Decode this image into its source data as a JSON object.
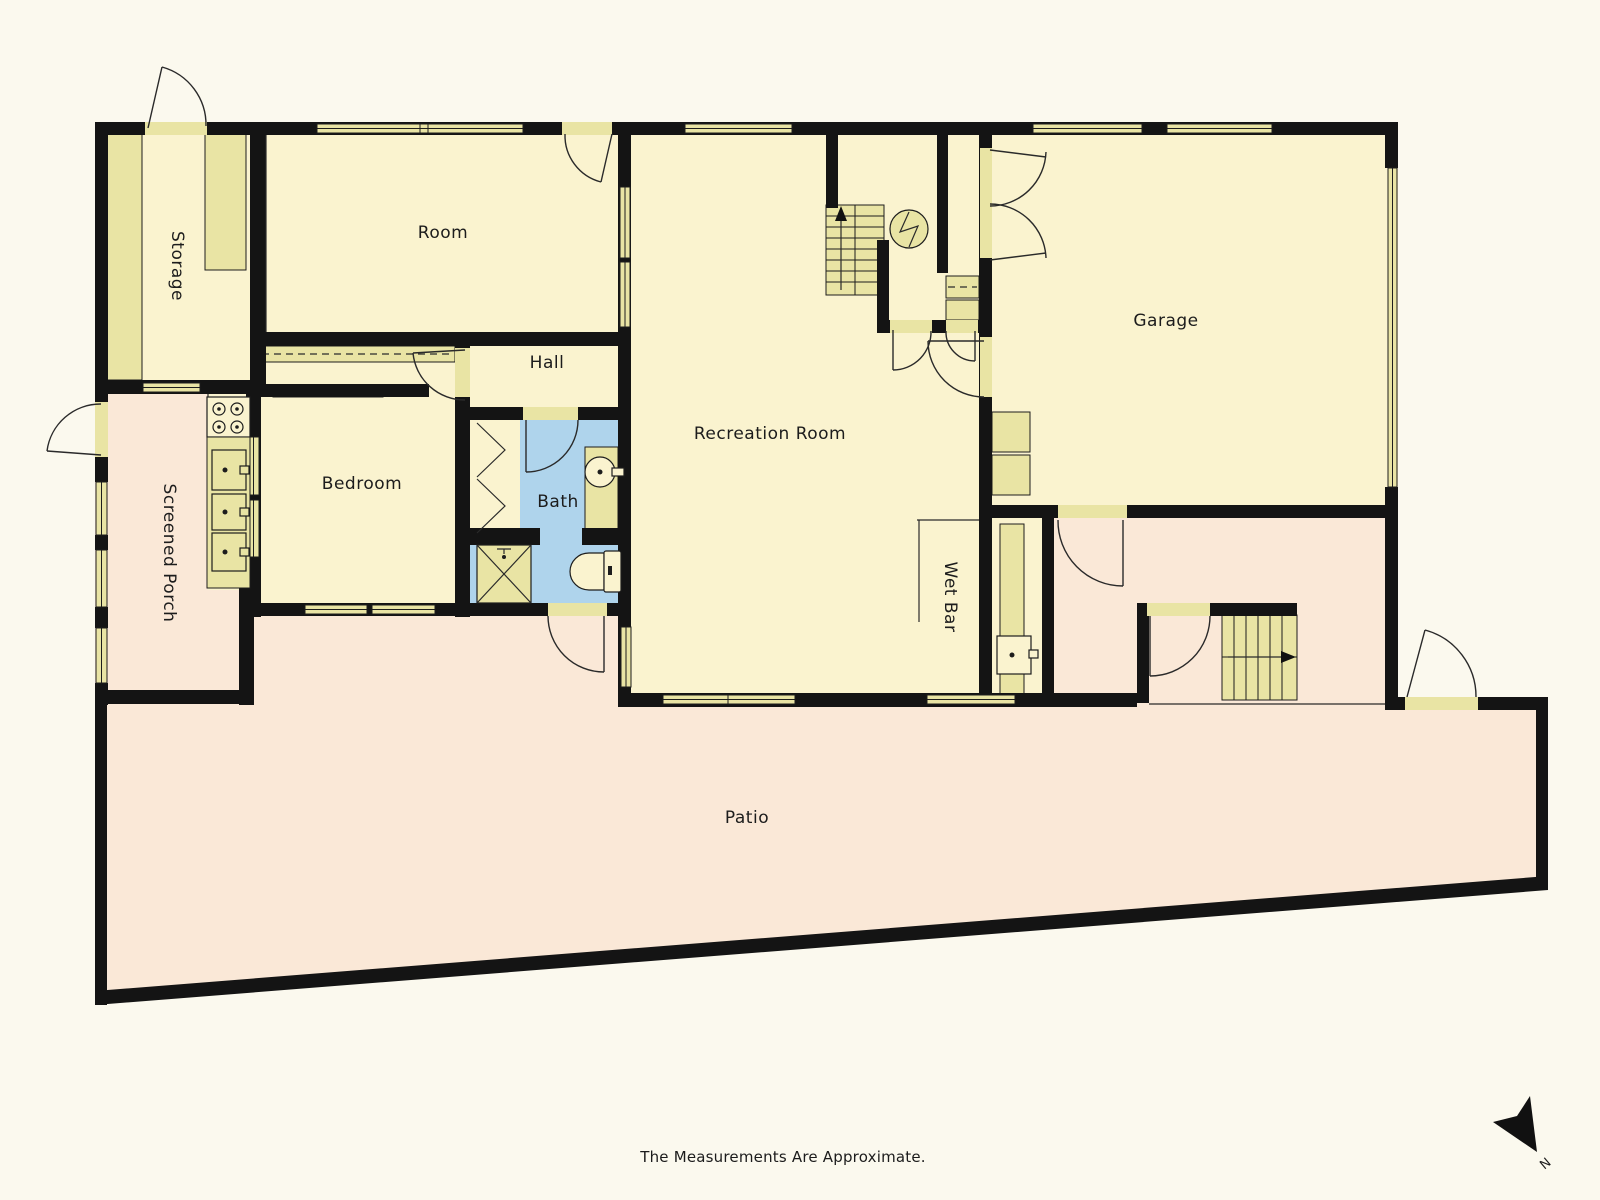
{
  "rooms": {
    "storage": "Storage",
    "room": "Room",
    "hall": "Hall",
    "bedroom": "Bedroom",
    "bath": "Bath",
    "recreation": "Recreation Room",
    "garage": "Garage",
    "wet_bar": "Wet Bar",
    "screened_porch": "Screened Porch",
    "patio": "Patio"
  },
  "footer": {
    "note": "The Measurements Are Approximate."
  },
  "compass": {
    "label": "N"
  },
  "colors": {
    "bg": "#fbf9ee",
    "wall": "#141414",
    "floor": "#faf3cf",
    "accent": "#e9e4a4",
    "accent2": "#f2edc2",
    "pink": "#fae8d7",
    "blue": "#afd4ec",
    "text": "#1c1c1c"
  }
}
